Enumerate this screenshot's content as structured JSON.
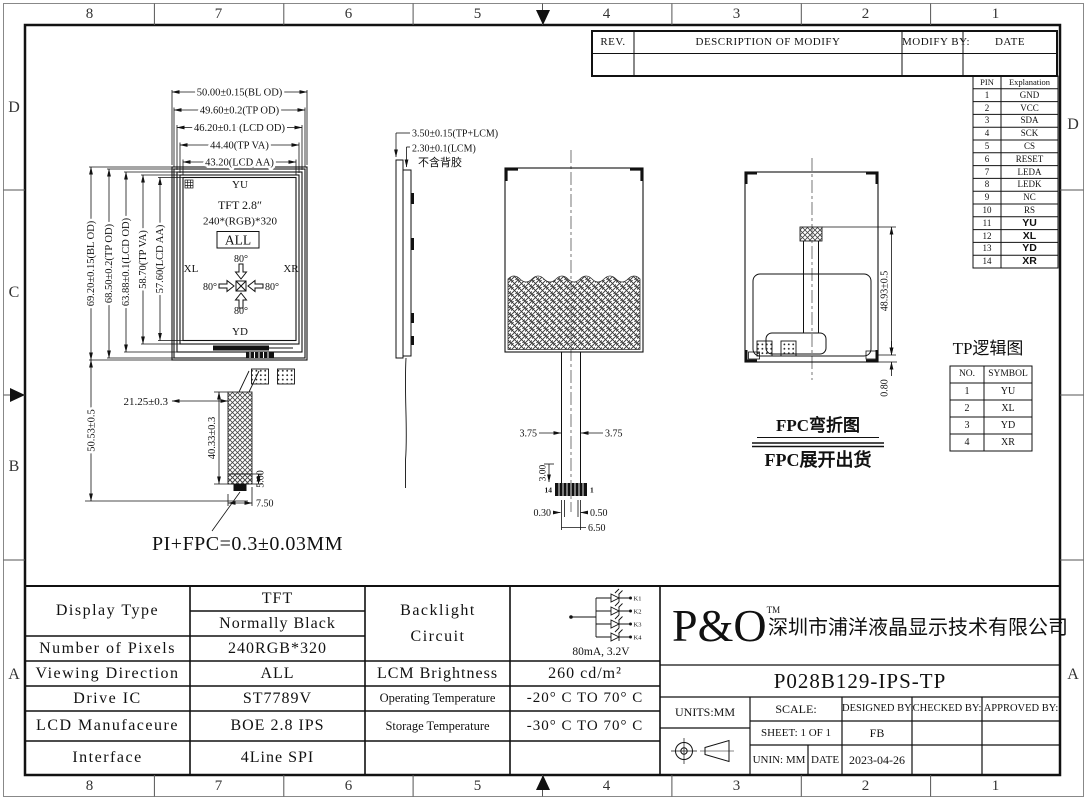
{
  "border": {
    "top": [
      "8",
      "7",
      "6",
      "5",
      "4",
      "3",
      "2",
      "1"
    ],
    "bottom": [
      "8",
      "7",
      "6",
      "5",
      "4",
      "3",
      "2",
      "1"
    ],
    "left": [
      "D",
      "C",
      "B",
      "A"
    ],
    "right": [
      "D",
      "A"
    ]
  },
  "revision_table": {
    "headers": [
      "REV.",
      "DESCRIPTION OF MODIFY",
      "MODIFY BY:",
      "DATE"
    ]
  },
  "pin_table": {
    "headers": [
      "PIN",
      "Explanation"
    ],
    "rows": [
      [
        "1",
        "GND"
      ],
      [
        "2",
        "VCC"
      ],
      [
        "3",
        "SDA"
      ],
      [
        "4",
        "SCK"
      ],
      [
        "5",
        "CS"
      ],
      [
        "6",
        "RESET"
      ],
      [
        "7",
        "LEDA"
      ],
      [
        "8",
        "LEDK"
      ],
      [
        "9",
        "NC"
      ],
      [
        "10",
        "RS"
      ],
      [
        "11",
        "YU"
      ],
      [
        "12",
        "XL"
      ],
      [
        "13",
        "YD"
      ],
      [
        "14",
        "XR"
      ]
    ]
  },
  "front_view": {
    "top_dims": [
      "50.00±0.15(BL OD)",
      "49.60±0.2(TP OD)",
      "46.20±0.1 (LCD OD)",
      "44.40(TP VA)",
      "43.20(LCD AA)"
    ],
    "left_dims": [
      "69.20±0.15(BL OD)",
      "68.50±0.2(TP OD)",
      "63.88±0.1(LCD OD)",
      "58.70(TP VA)",
      "57.60(LCD AA)"
    ],
    "labels": {
      "top": "YU",
      "bottom": "YD",
      "left": "XL",
      "right": "XR",
      "size": "TFT 2.8″",
      "resolution": "240*(RGB)*320",
      "viewing": "ALL",
      "angle": "80°"
    },
    "dim_total_height": "50.53±0.5",
    "dim_fpc_offset": "21.25±0.3",
    "dim_fpc_length": "40.33±0.3",
    "dim_stiffener": "5.00",
    "dim_fpc_width": "7.50",
    "note": "PI+FPC=0.3±0.03MM"
  },
  "side_view": {
    "dim1": "3.50±0.15(TP+LCM)",
    "dim2": "2.30±0.1(LCM)",
    "note": "不含背胶"
  },
  "tp_view": {
    "dim_left": "3.75",
    "dim_right": "3.75",
    "dim_3": "3.00",
    "dim_030": "0.30",
    "dim_050": "0.50",
    "dim_650": "6.50",
    "pin_left": "14",
    "pin_right": "1"
  },
  "back_view": {
    "dim_height": "48.93±0.5",
    "dim_080": "0.80"
  },
  "tp_logic": {
    "title": "TP逻辑图",
    "headers": [
      "NO.",
      "SYMBOL"
    ],
    "rows": [
      [
        "1",
        "YU"
      ],
      [
        "2",
        "XL"
      ],
      [
        "3",
        "YD"
      ],
      [
        "4",
        "XR"
      ]
    ]
  },
  "fpc_note": {
    "line1": "FPC弯折图",
    "line2": "FPC展开出货"
  },
  "spec_table": {
    "display_type_label": "Display Type",
    "display_type_value1": "TFT",
    "display_type_value2": "Normally Black",
    "rows_left": [
      {
        "label": "Number of Pixels",
        "value": "240RGB*320"
      },
      {
        "label": "Viewing Direction",
        "value": "ALL"
      },
      {
        "label": "Drive IC",
        "value": "ST7789V"
      },
      {
        "label": "LCD Manufaceure",
        "value": "BOE 2.8 IPS"
      },
      {
        "label": "Interface",
        "value": "4Line SPI"
      }
    ],
    "backlight_label": "Backlight Circuit",
    "backlight_spec": "80mA, 3.2V",
    "led_labels": [
      "K1",
      "K2",
      "K3",
      "K4"
    ],
    "rows_right": [
      {
        "label": "LCM Brightness",
        "value": "260 cd/m²"
      },
      {
        "label": "Operating Temperature",
        "value": "-20° C TO 70° C"
      },
      {
        "label": "Storage Temperature",
        "value": "-30° C TO 70° C"
      }
    ]
  },
  "title_block": {
    "logo": "P&O",
    "tm": "TM",
    "company": "深圳市浦洋液晶显示技术有限公司",
    "part_number": "P028B129-IPS-TP",
    "units": "UNITS:MM",
    "scale_label": "SCALE:",
    "designed_label": "DESIGNED BY:",
    "checked_label": "CHECKED BY:",
    "approved_label": "APPROVED BY:",
    "sheet": "SHEET: 1 OF 1",
    "designer": "FB",
    "unin": "UNIN: MM",
    "date_label": "DATE",
    "date": "2023-04-26"
  }
}
